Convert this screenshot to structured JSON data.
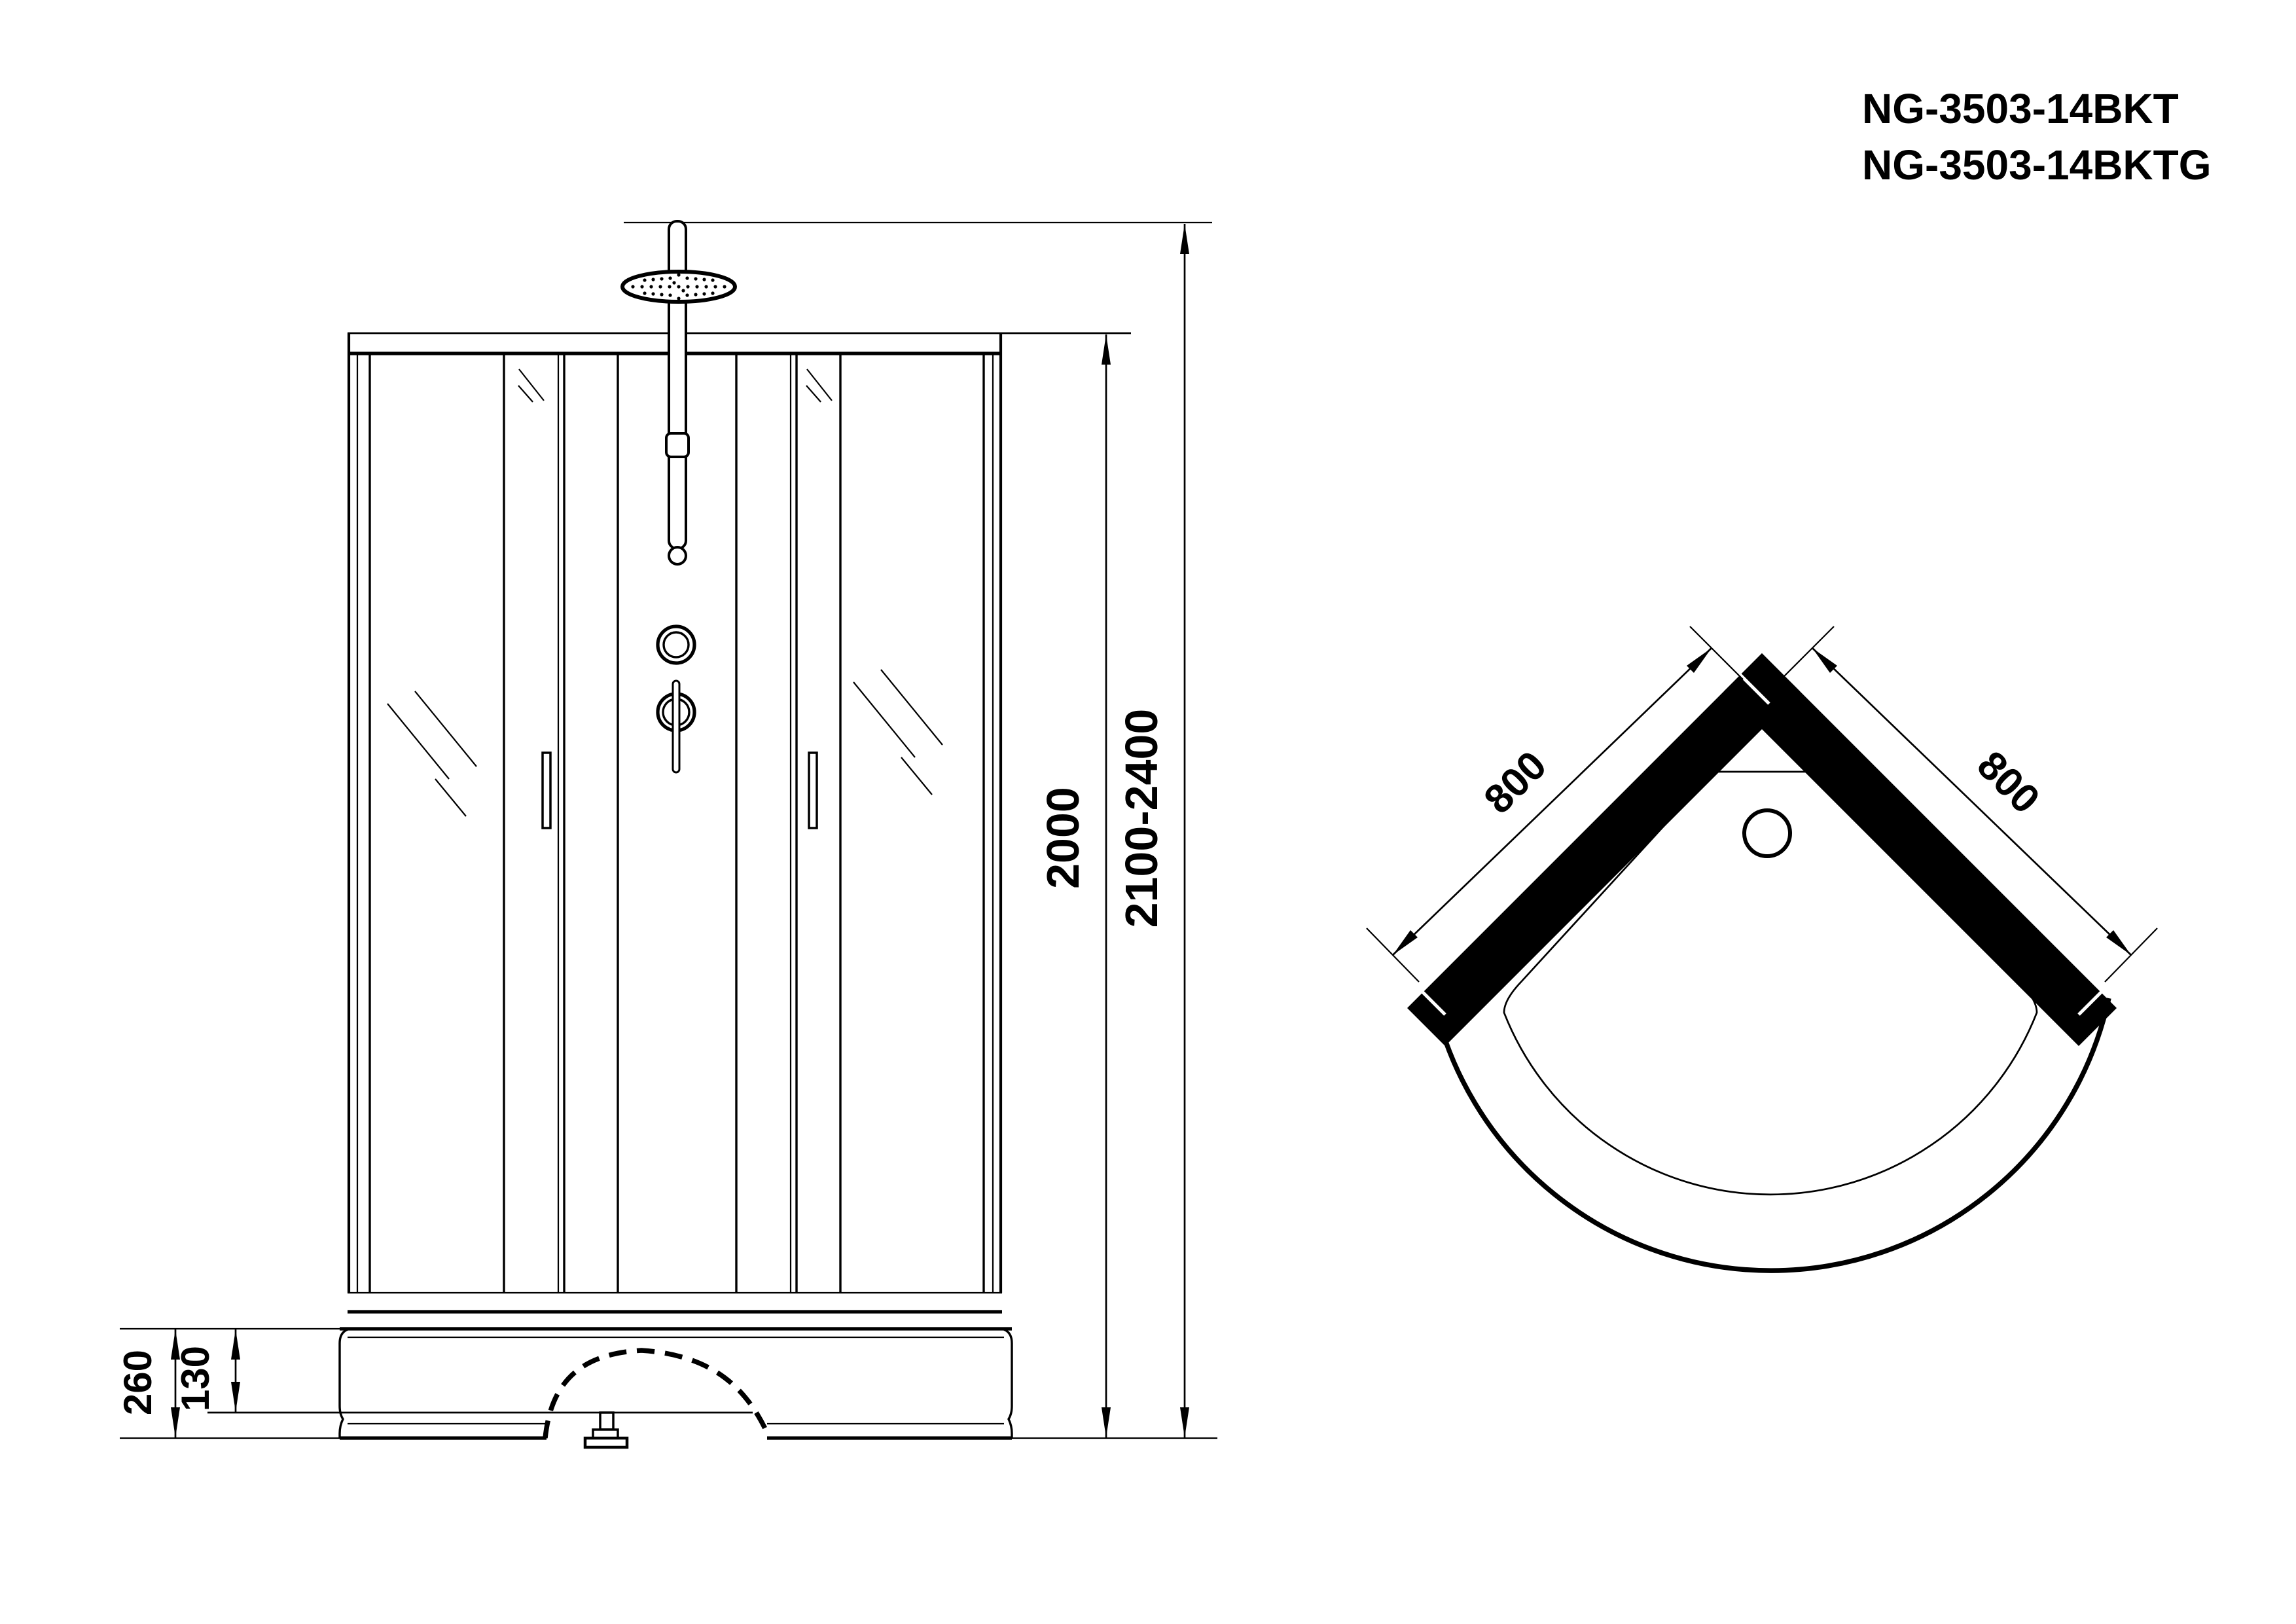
{
  "drawing": {
    "kind": "shower cabin technical drawing",
    "paper_color": "#ffffff",
    "ink_color": "#000000"
  },
  "title": {
    "line1": "NG-3503-14BKT",
    "line2": "NG-3503-14BKTG"
  },
  "front_view": {
    "label": "front elevation of shower cabin",
    "dimensions": {
      "cabin_height": "2000",
      "overall_height": "2100-2400",
      "tray_height": "260",
      "tray_inner_depth": "130"
    }
  },
  "top_view": {
    "label": "plan view of quadrant shower tray",
    "dimensions": {
      "left_side": "800",
      "right_side": "800"
    }
  }
}
